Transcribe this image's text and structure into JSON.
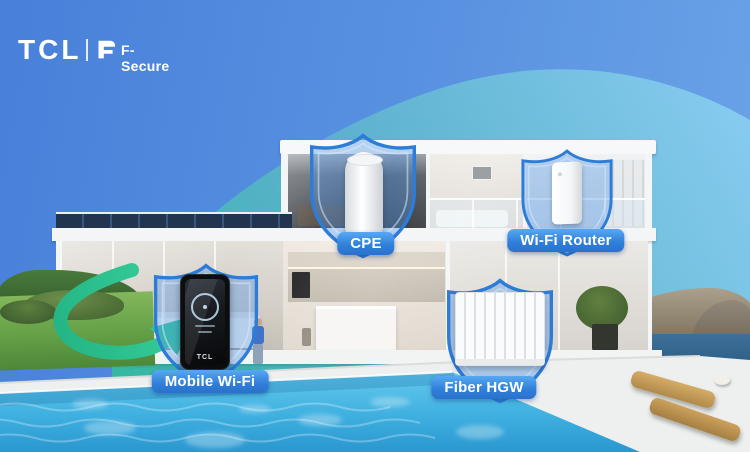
{
  "brand": {
    "tcl": "TCL",
    "fsecure": "F-Secure"
  },
  "callouts": {
    "cpe": {
      "label": "CPE",
      "icon": "shield-icon",
      "device": "cpe-tower-device"
    },
    "wifi_router": {
      "label": "Wi-Fi Router",
      "icon": "shield-icon",
      "device": "wifi-router-device"
    },
    "mobile_wifi": {
      "label": "Mobile Wi-Fi",
      "icon": "shield-icon",
      "device": "mobile-hotspot-device",
      "device_logo": "TCL"
    },
    "fiber_hgw": {
      "label": "Fiber HGW",
      "icon": "shield-icon",
      "device": "fiber-gateway-device"
    }
  },
  "graphics": {
    "arrow": "green-swoosh-arrow",
    "swoosh": "teal-arc-overlay"
  },
  "colors": {
    "sky_blue": "#4e87dc",
    "swoosh_teal": "#49c4a6",
    "arrow_green": "#2cc28f",
    "shield_blue": "#2d7cd8",
    "label_blue": "#2f7ed9",
    "pool_cyan": "#3fb4e3"
  }
}
